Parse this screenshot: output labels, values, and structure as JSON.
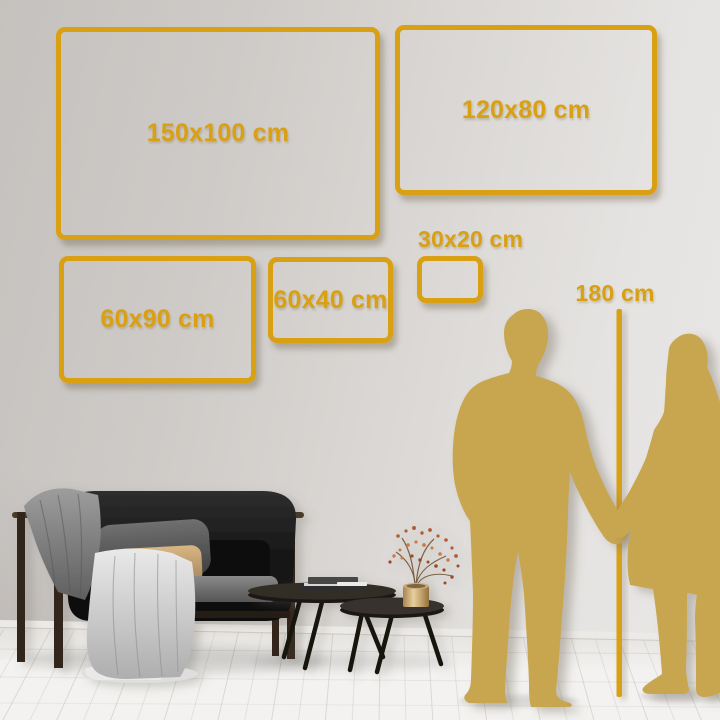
{
  "colors": {
    "accent_gold": "#D9A014",
    "silhouette_gold": "#C8A64F",
    "wall_light": "#EAE8E6",
    "wall_dark": "#C5C1BE",
    "floor_white": "#F3F2F0"
  },
  "size_guide": {
    "frames": [
      {
        "id": "150x100",
        "label": "150x100 cm",
        "width_cm": 150,
        "height_cm": 100,
        "x": 56,
        "y": 27,
        "w": 324,
        "h": 213,
        "label_position": "center"
      },
      {
        "id": "120x80",
        "label": "120x80 cm",
        "width_cm": 120,
        "height_cm": 80,
        "x": 395,
        "y": 25,
        "w": 262,
        "h": 170,
        "label_position": "center"
      },
      {
        "id": "60x90",
        "label": "60x90 cm",
        "width_cm": 60,
        "height_cm": 90,
        "x": 59,
        "y": 256,
        "w": 197,
        "h": 127,
        "label_position": "center"
      },
      {
        "id": "60x40",
        "label": "60x40 cm",
        "width_cm": 60,
        "height_cm": 40,
        "x": 268,
        "y": 257,
        "w": 125,
        "h": 86,
        "label_position": "center"
      },
      {
        "id": "30x20",
        "label": "30x20 cm",
        "width_cm": 30,
        "height_cm": 20,
        "x": 417,
        "y": 256,
        "w": 66,
        "h": 47,
        "label_position": "above"
      }
    ],
    "height_marker": {
      "label": "180 cm",
      "height_cm": 180,
      "line_x": 619,
      "line_top": 309,
      "line_bottom": 697
    }
  }
}
